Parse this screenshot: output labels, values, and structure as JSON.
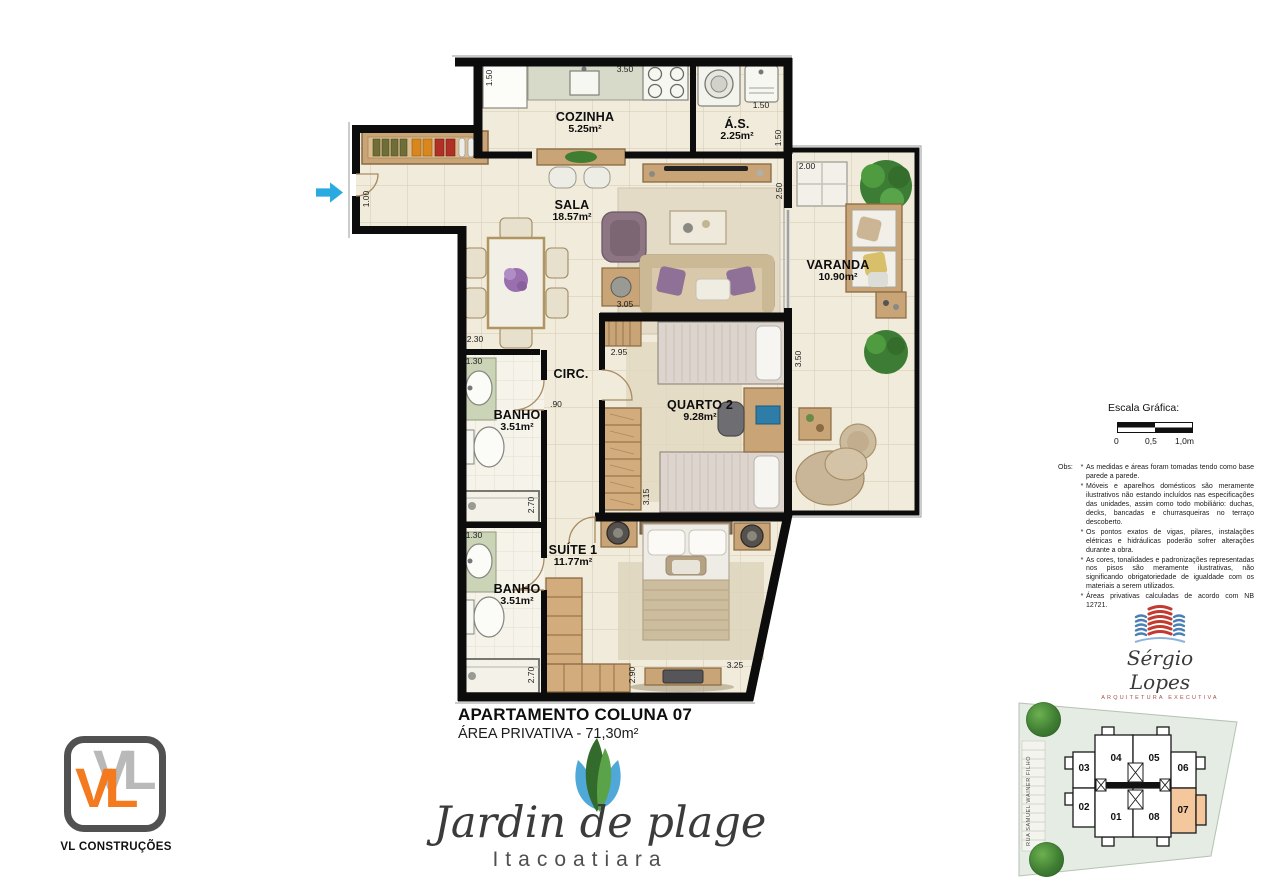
{
  "plan": {
    "rooms": [
      {
        "name": "COZINHA",
        "area": "5.25m²"
      },
      {
        "name": "Á.S.",
        "area": "2.25m²"
      },
      {
        "name": "SALA",
        "area": "18.57m²"
      },
      {
        "name": "VARANDA",
        "area": "10.90m²"
      },
      {
        "name": "CIRC.",
        "area": ""
      },
      {
        "name": "BANHO",
        "area": "3.51m²"
      },
      {
        "name": "QUARTO 2",
        "area": "9.28m²"
      },
      {
        "name": "BANHO",
        "area": "3.51m²"
      },
      {
        "name": "SUÍTE 1",
        "area": "11.77m²"
      }
    ],
    "dims": {
      "d0": "1.50",
      "d1": "3.50",
      "d2": "1.50",
      "d3": "1.50",
      "d4": "2.50",
      "d5": "2.00",
      "d6": "3.50",
      "d7": "1.00",
      "d8": "2.30",
      "d9": "1.30",
      "d10": ".90",
      "d11": "3.05",
      "d12": "2.95",
      "d13": "3.15",
      "d14": "2.70",
      "d15": "1.30",
      "d16": "2.70",
      "d17": "2.90",
      "d18": "3.25"
    }
  },
  "title": {
    "line1": "APARTAMENTO COLUNA 07",
    "line2": "ÁREA PRIVATIVA - 71,30m²"
  },
  "scale": {
    "title": "Escala Gráfica:",
    "labels": [
      "0",
      "0,5",
      "1,0m"
    ]
  },
  "obs": {
    "label": "Obs:",
    "bullet": "*",
    "items": [
      "As medidas e áreas foram tomadas tendo como base parede a parede.",
      "Móveis e aparelhos domésticos são meramente ilustrativos não estando incluídos nas especificações das unidades, assim como todo mobiliário: duchas, decks, bancadas e churrasqueiras no terraço descoberto.",
      "Os pontos exatos de vigas, pilares, instalações elétricas e hidráulicas poderão sofrer alterações durante a obra.",
      "As cores, tonalidades e padronizações representadas nos pisos são meramente ilustrativas, não significando obrigatoriedade de igualdade com os materiais a serem utilizados.",
      "Áreas privativas calculadas de acordo com NB 12721."
    ]
  },
  "architect": {
    "name": "Sérgio Lopes",
    "subtitle": "Arquitetura Executiva"
  },
  "keyplan": {
    "street": "RUA SAMUEL WAINER FILHO",
    "units": {
      "u01": "01",
      "u02": "02",
      "u03": "03",
      "u04": "04",
      "u05": "05",
      "u06": "06",
      "u07": "07",
      "u08": "08"
    }
  },
  "builder": {
    "monogram": "VL",
    "name": "VL CONSTRUÇÕES"
  },
  "development": {
    "name": "Jardin de plage",
    "location": "Itacoatiara"
  },
  "colors": {
    "wall": "#0c0c0c",
    "floor": "#F1EBDB",
    "arrow_blue": "#29ABE2",
    "unit_highlight": "#F5C79D",
    "logo_orange": "#F47A1F"
  }
}
